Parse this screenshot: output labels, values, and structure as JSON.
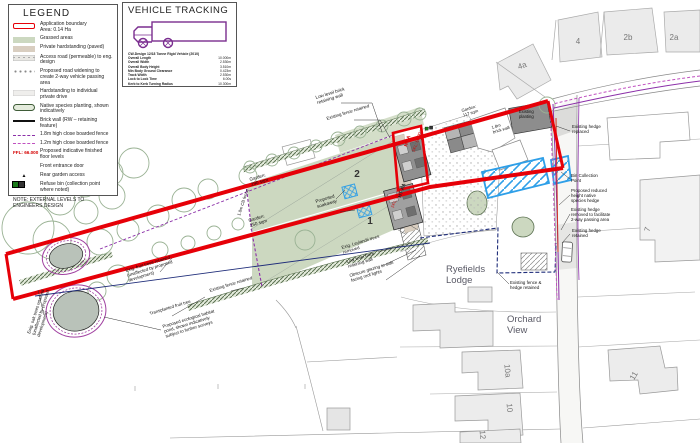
{
  "colors": {
    "boundary_red": "#e60008",
    "grass_green": "#ccd8c0",
    "paving_tan": "#d9cec0",
    "widening_blue": "#2e9fe8",
    "fence_purple": "#8b2fa8",
    "fence_magenta": "#c050c0",
    "ffl_red": "#d40000",
    "existing_fence_navy": "#1f2d7a",
    "hedge_green": "#5a7050",
    "tracking_purple": "#7a2d8f"
  },
  "legend": {
    "title": "LEGEND",
    "items": [
      {
        "swatch": "boundary",
        "label": "Application boundary\nArea: 0.14 Ha"
      },
      {
        "swatch": "grass",
        "label": "Grassed areas"
      },
      {
        "swatch": "paved",
        "label": "Private hardstanding (paved)"
      },
      {
        "swatch": "access",
        "label": "Access road (permeable) to eng. design"
      },
      {
        "swatch": "widening",
        "label": "Proposed road widening to create 2-way vehicle passing area"
      },
      {
        "swatch": "drive",
        "label": "Hardstanding to individual private drive"
      },
      {
        "swatch": "planting",
        "label": "Native species planting, shown indicatively"
      },
      {
        "swatch": "wall",
        "label": "Brick wall (RW – retaining feature)"
      },
      {
        "swatch": "fence18",
        "label": "1.8m high close boarded fence"
      },
      {
        "swatch": "fence12",
        "label": "1.2m high close boarded fence"
      },
      {
        "swatch": "ffl",
        "swatch_text": "FFL: 66.000",
        "label": "Proposed indicative finished floor levels"
      },
      {
        "swatch": "door",
        "label": "Front entrance door"
      },
      {
        "swatch": "rear",
        "label": "Rear garden access"
      },
      {
        "swatch": "bin",
        "label": "Refuse bin (collection point where noted)"
      }
    ],
    "note": "NOTE: EXTERNAL LEVELS TO ENGINEERS DESIGN"
  },
  "vehicle_tracking": {
    "title": "VEHICLE TRACKING",
    "vehicle": "CW-Design 12/18 Tonne Rigid Vehicle (2010)",
    "specs": [
      {
        "name": "Overall Length",
        "value": "10.000m"
      },
      {
        "name": "Overall Width",
        "value": "2.530m"
      },
      {
        "name": "Overall Body Height",
        "value": "3.510m"
      },
      {
        "name": "Min Body Ground Clearance",
        "value": "0.423m"
      },
      {
        "name": "Track Width",
        "value": "2.530m"
      },
      {
        "name": "Lock to Lock Time",
        "value": "6.00s"
      },
      {
        "name": "Kerb to Kerb Turning Radius",
        "value": "10.300m"
      }
    ]
  },
  "plan": {
    "labels": [
      {
        "name": "low-level-brick-wall-n",
        "text": "Low level brick\nretaining wall",
        "x": 316,
        "y": 99,
        "rot": -17,
        "size": 4.6
      },
      {
        "name": "existing-fence-retained-n",
        "text": "Existing fence retained",
        "x": 327,
        "y": 120,
        "rot": -17,
        "size": 4.4
      },
      {
        "name": "garden-290",
        "text": "Garden:\n290 sqm",
        "x": 250,
        "y": 181,
        "rot": -17,
        "size": 4.6
      },
      {
        "name": "garden-250",
        "text": "Garden:\n250 sqm",
        "x": 249,
        "y": 222,
        "rot": -17,
        "size": 4.6
      },
      {
        "name": "fence-18-cb",
        "text": "1.8m CB fence",
        "x": 240,
        "y": 216,
        "rot": -72,
        "size": 4.2
      },
      {
        "name": "plot-2",
        "text": "2",
        "x": 357,
        "y": 177,
        "rot": 0,
        "size": 10,
        "weight": "bold",
        "color": "#333",
        "anchor": "middle"
      },
      {
        "name": "plot-1",
        "text": "1",
        "x": 370,
        "y": 224,
        "rot": 0,
        "size": 10,
        "weight": "bold",
        "color": "#333",
        "anchor": "middle"
      },
      {
        "name": "proposed-soakaway",
        "text": "Proposed\nsoakaway",
        "x": 316,
        "y": 203,
        "rot": -17,
        "size": 4.6
      },
      {
        "name": "ht-a",
        "text": "HT A",
        "x": 407,
        "y": 147,
        "rot": -72,
        "size": 5,
        "color": "#d40000",
        "weight": "bold"
      },
      {
        "name": "ffl-66-00",
        "text": "FFL: 66.00",
        "x": 415,
        "y": 152,
        "rot": -72,
        "size": 4.2,
        "color": "#d40000"
      },
      {
        "name": "ht-aa",
        "text": "HT AA",
        "x": 401,
        "y": 198,
        "rot": -72,
        "size": 5,
        "color": "#222",
        "weight": "bold"
      },
      {
        "name": "ffl-66-10",
        "text": "FFL: 66.10",
        "x": 394,
        "y": 208,
        "rot": -72,
        "size": 4.2,
        "color": "#d40000"
      },
      {
        "name": "leylandii-removed",
        "text": "Exig. Leylandii trees\nremoved",
        "x": 342,
        "y": 249,
        "rot": -17,
        "size": 4.4
      },
      {
        "name": "low-level-brick-wall-s",
        "text": "Low level brick\nretaining wall",
        "x": 347,
        "y": 263,
        "rot": -17,
        "size": 4.4
      },
      {
        "name": "obscure-glazing",
        "text": "Obscure glazing to side\nfacing roof lights",
        "x": 350,
        "y": 277,
        "rot": -17,
        "size": 4.4
      },
      {
        "name": "existing-fence-retained-s",
        "text": "Existing fence retained",
        "x": 210,
        "y": 292,
        "rot": -17,
        "size": 4.4
      },
      {
        "name": "fruit-trees-retained",
        "text": "Exig. fruit trees retained\n(unaffected by proposed\ndevelopment)",
        "x": 126,
        "y": 272,
        "rot": -17,
        "size": 4.4
      },
      {
        "name": "transplanted-fruit-tree",
        "text": "Transplanted fruit tree",
        "x": 150,
        "y": 315,
        "rot": -17,
        "size": 4.4
      },
      {
        "name": "habitat-pond",
        "text": "Proposed ecological habitat\npond, shown indicatively\nsubject to further surveys",
        "x": 163,
        "y": 328,
        "rot": -17,
        "size": 4.4
      },
      {
        "name": "oak-trees-retained",
        "text": "Exig. oak trees retained\n(unaffected by proposed\ndevelopment)",
        "x": 30,
        "y": 334,
        "rot": -72,
        "size": 4.4
      },
      {
        "name": "garden-117",
        "text": "Garden:\n117 sqm",
        "x": 462,
        "y": 112,
        "rot": -17,
        "size": 4.2
      },
      {
        "name": "brick-wall-18",
        "text": "1.8m\nbrick wall",
        "x": 492,
        "y": 129,
        "rot": -17,
        "size": 4.2
      },
      {
        "name": "existing-planting",
        "text": "Existing\nplanting",
        "x": 519,
        "y": 113,
        "rot": 0,
        "size": 4.2
      },
      {
        "name": "existing-hedge-replaced",
        "text": "Existing hedge\nreplaced",
        "x": 572,
        "y": 128,
        "rot": 0,
        "size": 4.4
      },
      {
        "name": "bin-collection-point",
        "text": "Bin Collection\nPoint",
        "x": 571,
        "y": 177,
        "rot": 0,
        "size": 4.4
      },
      {
        "name": "reduced-height-hedge",
        "text": "Proposed reduced\nheight native\nspecies hedge",
        "x": 571,
        "y": 192,
        "rot": 0,
        "size": 4.4
      },
      {
        "name": "hedge-removed-passing",
        "text": "Existing hedge\nremoved to facilitate\n2-way passing area",
        "x": 571,
        "y": 211,
        "rot": 0,
        "size": 4.4
      },
      {
        "name": "existing-hedge-retained",
        "text": "Existing hedge\nretained",
        "x": 572,
        "y": 232,
        "rot": 0,
        "size": 4.4
      },
      {
        "name": "existing-fence-hedge-retained",
        "text": "Existing fence &\nhedge retained",
        "x": 510,
        "y": 284,
        "rot": 0,
        "size": 4.4
      },
      {
        "name": "ryefields-lodge",
        "text": "Ryefields\nLodge",
        "x": 446,
        "y": 272,
        "rot": 0,
        "size": 9.5,
        "color": "#5a5a66"
      },
      {
        "name": "orchard-view",
        "text": "Orchard\nView",
        "x": 507,
        "y": 322,
        "rot": 0,
        "size": 9.5,
        "color": "#5a5a66"
      },
      {
        "name": "parcel-4a",
        "text": "4a",
        "x": 523,
        "y": 68,
        "rot": -20,
        "size": 8,
        "color": "#777",
        "anchor": "middle"
      },
      {
        "name": "parcel-4",
        "text": "4",
        "x": 578,
        "y": 44,
        "rot": 0,
        "size": 8,
        "color": "#777",
        "anchor": "middle"
      },
      {
        "name": "parcel-2b",
        "text": "2b",
        "x": 628,
        "y": 40,
        "rot": 0,
        "size": 8,
        "color": "#777",
        "anchor": "middle"
      },
      {
        "name": "parcel-2a",
        "text": "2a",
        "x": 674,
        "y": 40,
        "rot": 0,
        "size": 8,
        "color": "#777",
        "anchor": "middle"
      },
      {
        "name": "parcel-7",
        "text": "7",
        "x": 650,
        "y": 230,
        "rot": -75,
        "size": 8,
        "color": "#777",
        "anchor": "middle"
      },
      {
        "name": "parcel-11",
        "text": "11",
        "x": 636,
        "y": 377,
        "rot": -60,
        "size": 8,
        "color": "#777",
        "anchor": "middle"
      },
      {
        "name": "parcel-10a",
        "text": "10a",
        "x": 505,
        "y": 371,
        "rot": 85,
        "size": 8,
        "color": "#777",
        "anchor": "middle"
      },
      {
        "name": "parcel-10",
        "text": "10",
        "x": 507,
        "y": 408,
        "rot": 85,
        "size": 8,
        "color": "#777",
        "anchor": "middle"
      },
      {
        "name": "parcel-12",
        "text": "12",
        "x": 480,
        "y": 435,
        "rot": 85,
        "size": 8,
        "color": "#777",
        "anchor": "middle"
      }
    ]
  }
}
